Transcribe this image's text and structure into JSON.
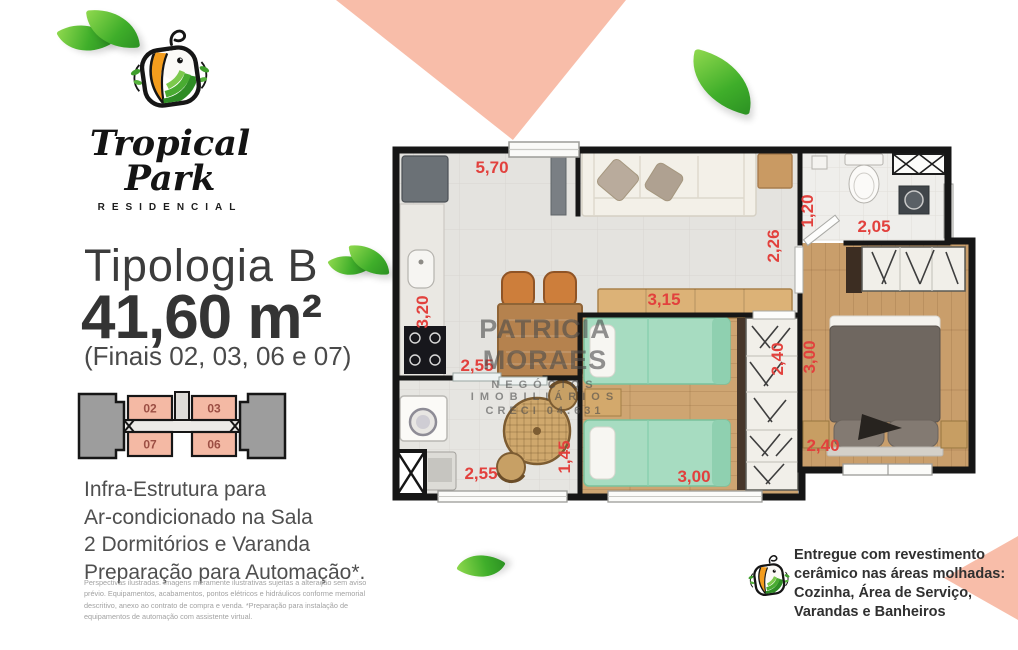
{
  "brand": {
    "name": "Tropical Park",
    "subtitle": "RESIDENCIAL"
  },
  "typology": {
    "title": "Tipologia B",
    "area": "41,60 m²",
    "units_note": "(Finais 02, 03, 06 e 07)"
  },
  "keyplan": {
    "units": [
      "02",
      "03",
      "07",
      "06"
    ]
  },
  "features": {
    "text": "Infra-Estrutura para\nAr-condicionado na Sala\n2 Dormitórios e Varanda\nPreparação para Automação*."
  },
  "disclaimer": {
    "text": "Perspectivas ilustradas. Imagens meramente ilustrativas sujeitas a alteração sem aviso prévio. Equipamentos, acabamentos, pontos elétricos e hidráulicos conforme memorial descritivo, anexo ao contrato de compra e venda. *Preparação para instalação de equipamentos de automação com assistente virtual."
  },
  "watermark": {
    "line1": "PATRICIA MORAES",
    "line2": "NEGÓCIOS IMOBILIÁRIOS",
    "line3": "CRECI 04.631"
  },
  "delivery_note": {
    "text": "Entregue com revestimento\ncerâmico nas áreas molhadas:\nCozinha, Área de Serviço,\nVarandas e Banheiros"
  },
  "plan": {
    "dimensions": {
      "kitchen_living_width": "5,70",
      "kitchen_height": "3,20",
      "kitchen_width": "2,55",
      "living_width": "3,15",
      "hall_height": "2,26",
      "bathroom_height": "1,20",
      "bathroom_width": "2,05",
      "balcony_width": "2,55",
      "balcony_height": "1,45",
      "bedroom2_width": "3,00",
      "bedroom2_height": "2,40",
      "master_height": "3,00",
      "master_width": "2,40"
    }
  },
  "colors": {
    "accent_salmon": "#f8bda9",
    "dimension_red": "#e2413d",
    "leaf_green": "#3fae2a",
    "keyplan_unit_fill": "#f4b9a4"
  }
}
